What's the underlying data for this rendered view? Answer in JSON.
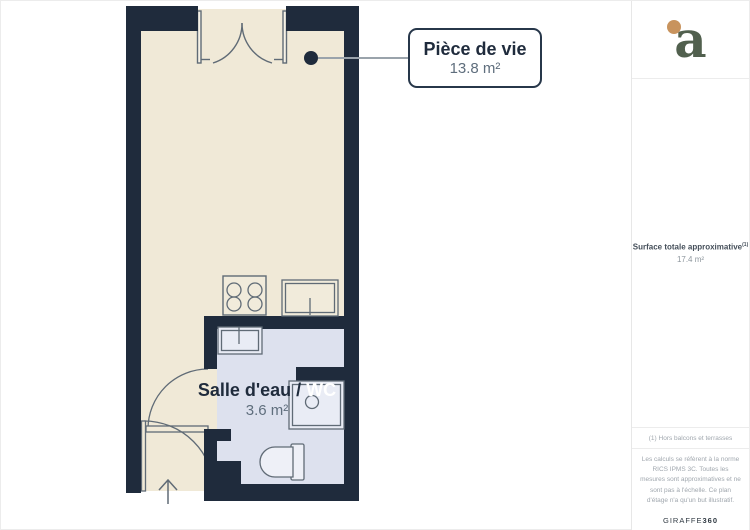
{
  "floorplan": {
    "living_room": {
      "name": "Pièce de vie",
      "area": "13.8 m²"
    },
    "bathroom": {
      "name_prefix": "Salle d'eau / ",
      "name_wc": "WC",
      "area": "3.6 m²"
    }
  },
  "sidebar": {
    "logo_letter": "a",
    "total": {
      "label": "Surface totale approximative",
      "reference_mark": "(1)",
      "value": "17.4 m²"
    },
    "footnote": "(1) Hors balcons et terrasses",
    "disclaimer": "Les calculs se réfèrent à la norme RICS IPMS 3C. Toutes les mesures sont approximatives et ne sont pas à l'échelle. Ce plan d'étage n'a qu'un but illustratif.",
    "brand": {
      "name": "GIRAFFE",
      "suffix": "360"
    }
  },
  "colors": {
    "wall": "#1f2b3c",
    "floor": "#f0e9d7",
    "wet_room_floor": "#dde1ee",
    "fixture_stroke": "#606b76",
    "fixture_fill": "#eef0f7",
    "leader": "#9aa3ab",
    "logo_green": "#51604e",
    "logo_dot": "#c8935d"
  }
}
